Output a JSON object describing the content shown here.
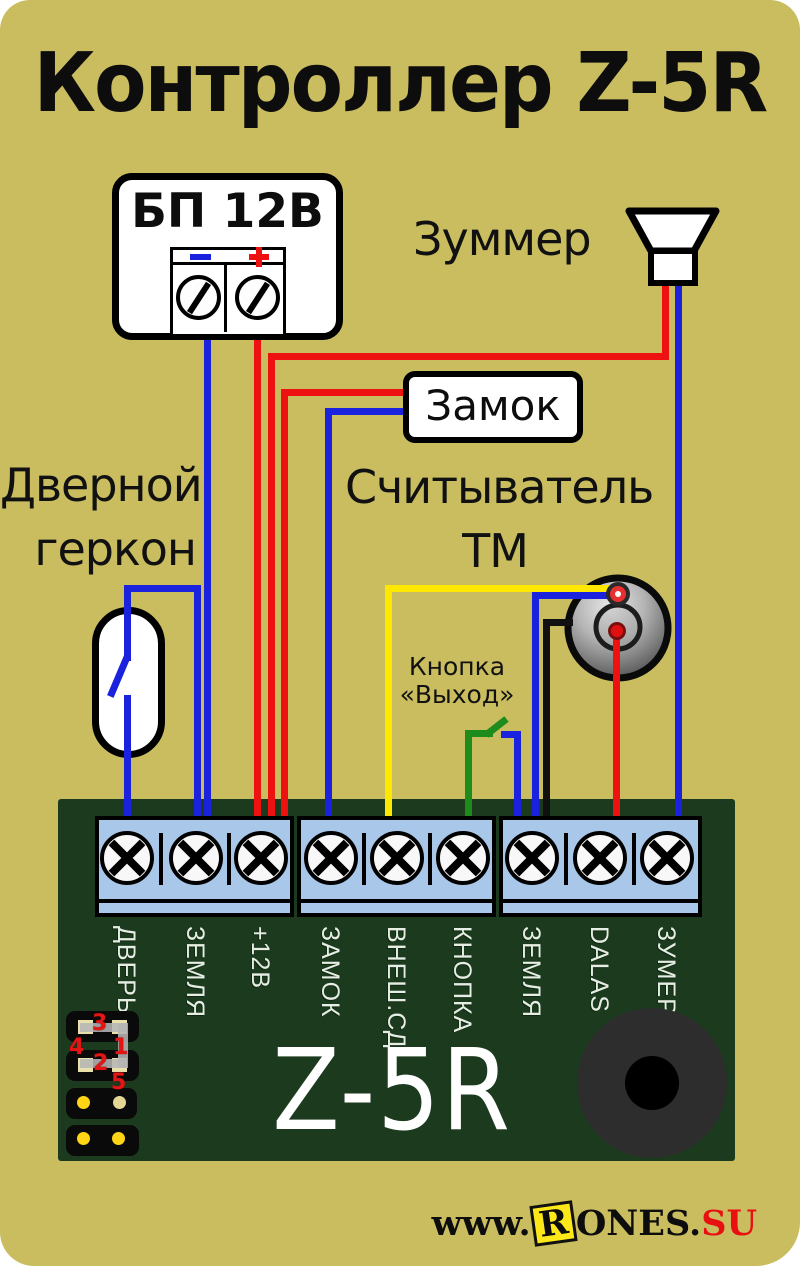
{
  "title": "Контроллер Z-5R",
  "psu": {
    "label": "БП 12В",
    "minus_sign": "−",
    "plus_sign": "+"
  },
  "buzzer": {
    "label": "Зуммер"
  },
  "lock": {
    "label": "Замок"
  },
  "reed": {
    "label_line1": "Дверной",
    "label_line2": "геркон"
  },
  "reader": {
    "label_line1": "Считыватель",
    "label_line2": "ТМ"
  },
  "exit_button": {
    "label_line1": "Кнопка",
    "label_line2": "«Выход»"
  },
  "board": {
    "name": "Z-5R",
    "terminals": [
      "ДВЕРЬ",
      "ЗЕМЛЯ",
      "+12В",
      "ЗАМОК",
      "ВНЕШ.СД",
      "КНОПКА",
      "ЗЕМЛЯ",
      "DALAS",
      "ЗУМЕР"
    ],
    "jumper_pins": [
      "3",
      "4",
      "1",
      "2",
      "5"
    ]
  },
  "watermark": {
    "prefix": "www.",
    "boxed_letter": "R",
    "middle": "ONES.",
    "suffix": "SU"
  },
  "colors": {
    "background": "#c9bd5f",
    "board_green": "#1c3a1e",
    "terminal_block_blue": "#a9c7e9",
    "wire_red": "#ee1111",
    "wire_blue": "#1a22dd",
    "wire_yellow": "#ffe800",
    "wire_green": "#1d8c1d",
    "wire_black": "#111111",
    "led_red": "#e83030",
    "watermark_red": "#e81010",
    "jumper_number_red": "#e31515"
  }
}
